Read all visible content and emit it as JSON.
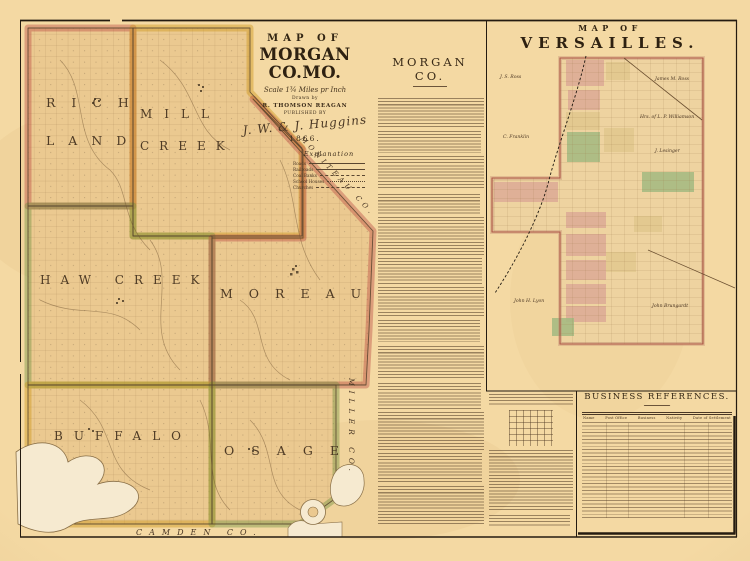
{
  "morgan_map": {
    "title": {
      "kicker": "MAP OF",
      "name": "MORGAN CO.MO.",
      "scale": "Scale 1¾ Miles pr Inch",
      "drawn_by": "Drawn by",
      "author": "R. THOMSON REAGAN",
      "published": "PUBLISHED BY",
      "signature": "J. W. & J. Huggins",
      "year": "1866."
    },
    "townships": [
      {
        "id": "richland",
        "lines": [
          "RICH",
          "LAND"
        ],
        "color": "#b8453e"
      },
      {
        "id": "mill-creek",
        "lines": [
          "MILL",
          "CREEK"
        ],
        "color": "#cf9a1e"
      },
      {
        "id": "haw-creek",
        "lines": [
          "HAW CREEK"
        ],
        "color": "#6f9140"
      },
      {
        "id": "moreau",
        "lines": [
          "MOREAU"
        ],
        "color": "#b8453e"
      },
      {
        "id": "buffalo",
        "lines": [
          "BUFFALO"
        ],
        "color": "#cf9a1e"
      },
      {
        "id": "osage",
        "lines": [
          "OSAGE"
        ],
        "color": "#6f9140"
      }
    ],
    "neighbors": {
      "south": "CAMDEN CO.",
      "east": "MILLER CO.",
      "northeast": "MONITEAU CO."
    },
    "explanation": {
      "title": "Explanation",
      "items": [
        "Roads",
        "Railroads",
        "Coal Banks",
        "School Houses",
        "Churches"
      ]
    }
  },
  "center_column": {
    "heading": "MORGAN CO."
  },
  "versailles": {
    "kicker": "MAP OF",
    "name": "VERSAILLES.",
    "owners": [
      "J. S. Ross",
      "C. Franklin",
      "James M. Ross",
      "Hrs. of L. P. Williamson",
      "J. Lesinger",
      "John H. Lyon",
      "John Brungardt"
    ]
  },
  "business_references": {
    "heading": "BUSINESS REFERENCES.",
    "columns": [
      "Name",
      "Post Office",
      "Business",
      "Nativity",
      "Date of Settlement"
    ]
  }
}
